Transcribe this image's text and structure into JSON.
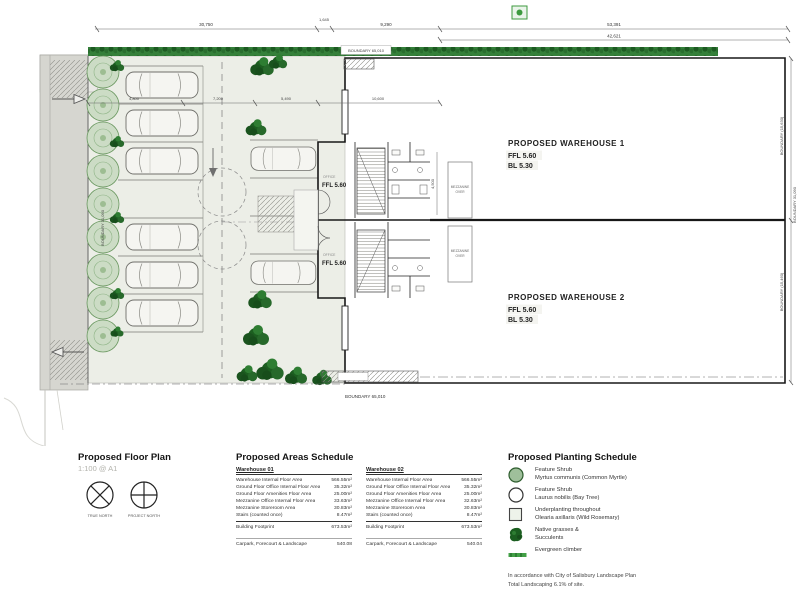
{
  "plan": {
    "dims": {
      "d1": "30,750",
      "d2": "1,645",
      "d3": "9,290",
      "d4": "53,391",
      "d5": "42,621",
      "i1": "4,800",
      "i2": "7,200",
      "i3": "5,490",
      "i4": "10,600",
      "v1": "4,500"
    },
    "boundaries": {
      "top": "BOUNDARY 65,010",
      "bottom": "BOUNDARY 65,010",
      "right_upper": "BOUNDARY (15,630)",
      "right_mid": "BOUNDARY 31,090",
      "right_lower": "BOUNDARY (15,460)",
      "left": "BOUNDARY 31,090"
    },
    "warehouse1": {
      "title": "PROPOSED WAREHOUSE 1",
      "ffl": "FFL 5.60",
      "bl": "BL 5.30"
    },
    "warehouse2": {
      "title": "PROPOSED WAREHOUSE 2",
      "ffl": "FFL 5.60",
      "bl": "BL 5.30"
    },
    "office1": {
      "name": "OFFICE",
      "ffl": "FFL 5.60"
    },
    "office2": {
      "name": "OFFICE",
      "ffl": "FFL 5.60"
    },
    "mezzanine": {
      "line1": "MEZZANINE",
      "line2": "OVER"
    }
  },
  "footer": {
    "floor_plan": {
      "title": "Proposed Floor Plan",
      "scale": "1:100 @ A1",
      "true_north": "TRUE NORTH",
      "project_north": "PROJECT NORTH"
    },
    "areas": {
      "title": "Proposed Areas Schedule",
      "columns": [
        {
          "header": "Warehouse 01",
          "rows": [
            {
              "label": "Warehouse Internal Floor Area",
              "value": "566.55m²"
            },
            {
              "label": "Ground Floor Office Internal Floor Area",
              "value": "35.32m²"
            },
            {
              "label": "Ground Floor Amenities Floor Area",
              "value": "25.00m²"
            },
            {
              "label": "Mezzanine Office Internal Floor Area",
              "value": "33.63m²"
            },
            {
              "label": "Mezzanine Storeroom Area",
              "value": "30.83m²"
            },
            {
              "label": "Stairs (counted once)",
              "value": "8.47m²"
            }
          ],
          "footprint": {
            "label": "Building Footprint",
            "value": "673.53m²"
          },
          "carpark": {
            "label": "Carpark, Forecourt & Landscape",
            "value": "540.08"
          }
        },
        {
          "header": "Warehouse 02",
          "rows": [
            {
              "label": "Warehouse Internal Floor Area",
              "value": "566.55m²"
            },
            {
              "label": "Ground Floor Office Internal Floor Area",
              "value": "35.32m²"
            },
            {
              "label": "Ground Floor Amenities Floor Area",
              "value": "25.00m²"
            },
            {
              "label": "Mezzanine Office Internal Floor Area",
              "value": "32.63m²"
            },
            {
              "label": "Mezzanine Storeroom Area",
              "value": "30.83m²"
            },
            {
              "label": "Stairs (counted once)",
              "value": "8.47m²"
            }
          ],
          "footprint": {
            "label": "Building Footprint",
            "value": "673.53m²"
          },
          "carpark": {
            "label": "Carpark, Forecourt & Landscape",
            "value": "540.04"
          }
        }
      ]
    },
    "planting": {
      "title": "Proposed Planting Schedule",
      "items": [
        {
          "symbol": "feature-shrub-filled-circle",
          "line1": "Feature Shrub",
          "line2": "Myrtus communis (Common Myrtle)"
        },
        {
          "symbol": "feature-shrub-open-circle",
          "line1": "Feature Shrub",
          "line2": "Laurus nobilis (Bay Tree)"
        },
        {
          "symbol": "underplanting-square",
          "line1": "Underplanting throughout",
          "line2": "Olearia axillaris (Wild Rosemary)"
        },
        {
          "symbol": "native-grasses-blob",
          "line1": "Native grasses &",
          "line2": "Succulents"
        },
        {
          "symbol": "evergreen-climber-bar",
          "line1": "Evergreen climber",
          "line2": ""
        }
      ],
      "note1": "In accordance with City of Salisbury Landscape Plan",
      "note2": "Total Landscaping 6.1% of site."
    }
  },
  "colors": {
    "hedge_green": "#35803a",
    "tree_green": "#1c5e20",
    "shrub_light": "#ccdcc5",
    "accent_green": "#3d9a3f",
    "paving": "#eceee7"
  }
}
